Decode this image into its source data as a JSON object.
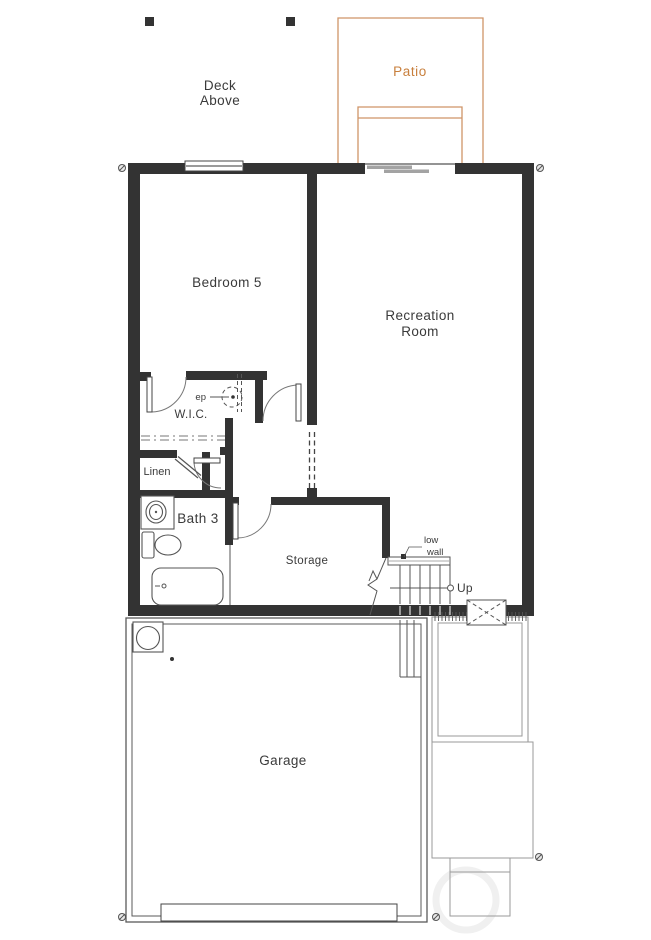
{
  "plan_labels": {
    "deck_above": {
      "line1": "Deck",
      "line2": "Above"
    },
    "patio": "Patio",
    "bedroom5": "Bedroom 5",
    "recreation_room": {
      "line1": "Recreation",
      "line2": "Room"
    },
    "ep": "ep",
    "wic": "W.I.C.",
    "linen": "Linen",
    "bath3": "Bath 3",
    "storage": "Storage",
    "low_wall": {
      "line1": "low",
      "line2": "wall"
    },
    "up": "Up",
    "garage": "Garage"
  },
  "colors": {
    "wall": "#333333",
    "patio_accent": "#c87f3c",
    "patio_line": "#cf9468",
    "line": "#555555",
    "slider_panel": "#a3a3a3"
  }
}
